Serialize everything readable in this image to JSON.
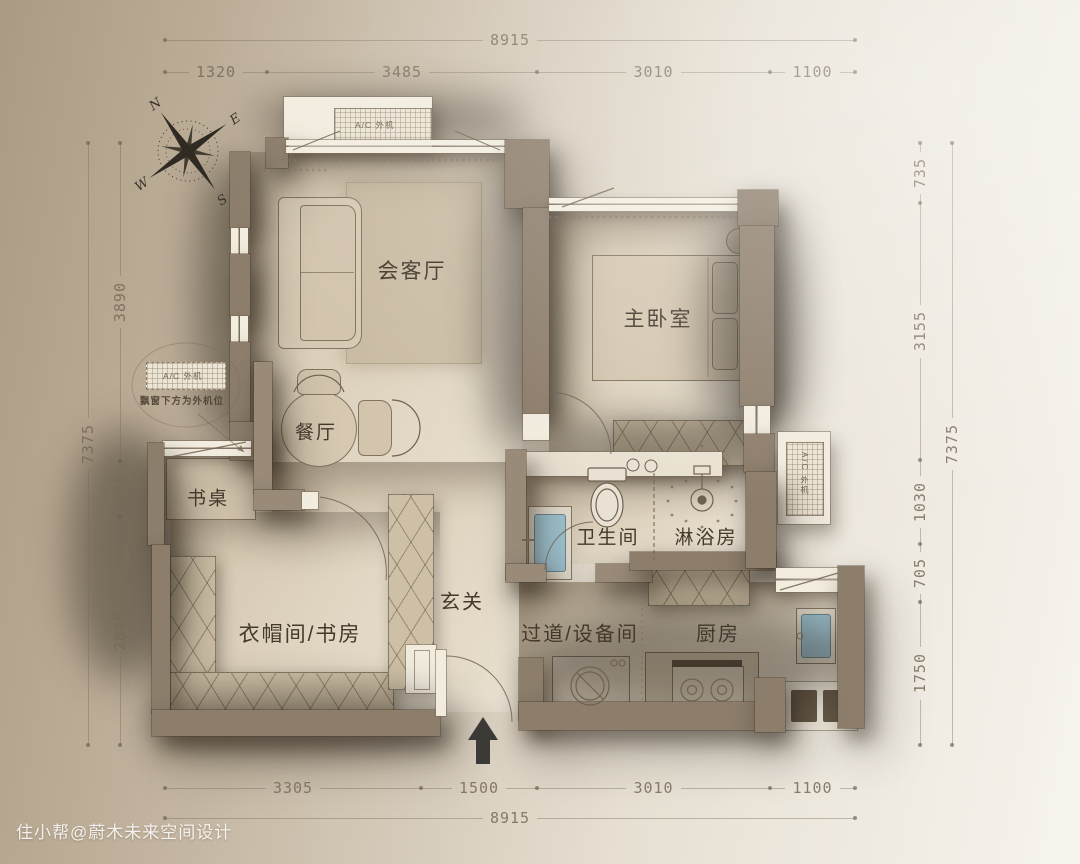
{
  "watermark": "住小帮@蔚木未来空间设计",
  "compass": {
    "n": "N",
    "e": "E",
    "s": "S",
    "w": "W"
  },
  "rooms": {
    "living": "会客厅",
    "bedroom": "主卧室",
    "dining": "餐厅",
    "desk": "书桌",
    "cloak": "衣帽间/书房",
    "entry": "玄关",
    "bath": "卫生间",
    "shower": "淋浴房",
    "corridor": "过道/设备间",
    "kitchen": "厨房"
  },
  "ac": {
    "top": "A/C 外机",
    "side": "A/C 外机",
    "callout_box": "A/C 外机",
    "callout_note": "飘窗下方为外机位"
  },
  "dims": {
    "top_total": "8915",
    "top": [
      "1320",
      "3485",
      "3010",
      "1100"
    ],
    "left_total": "7375",
    "left": [
      "3890",
      "685",
      "2800"
    ],
    "right_total": "7375",
    "right": [
      "735",
      "3155",
      "1030",
      "705",
      "1750"
    ],
    "bottom": [
      "3305",
      "1500",
      "3010",
      "1100"
    ],
    "bottom_total": "8915"
  },
  "colors": {
    "wall": "#8d7d6b",
    "floor": "#ddd1bc",
    "fixture_blue": "#9fc2cf",
    "label_text": "#43392c",
    "background_left": "#ab9a83",
    "background_right": "#f7f4ee"
  }
}
